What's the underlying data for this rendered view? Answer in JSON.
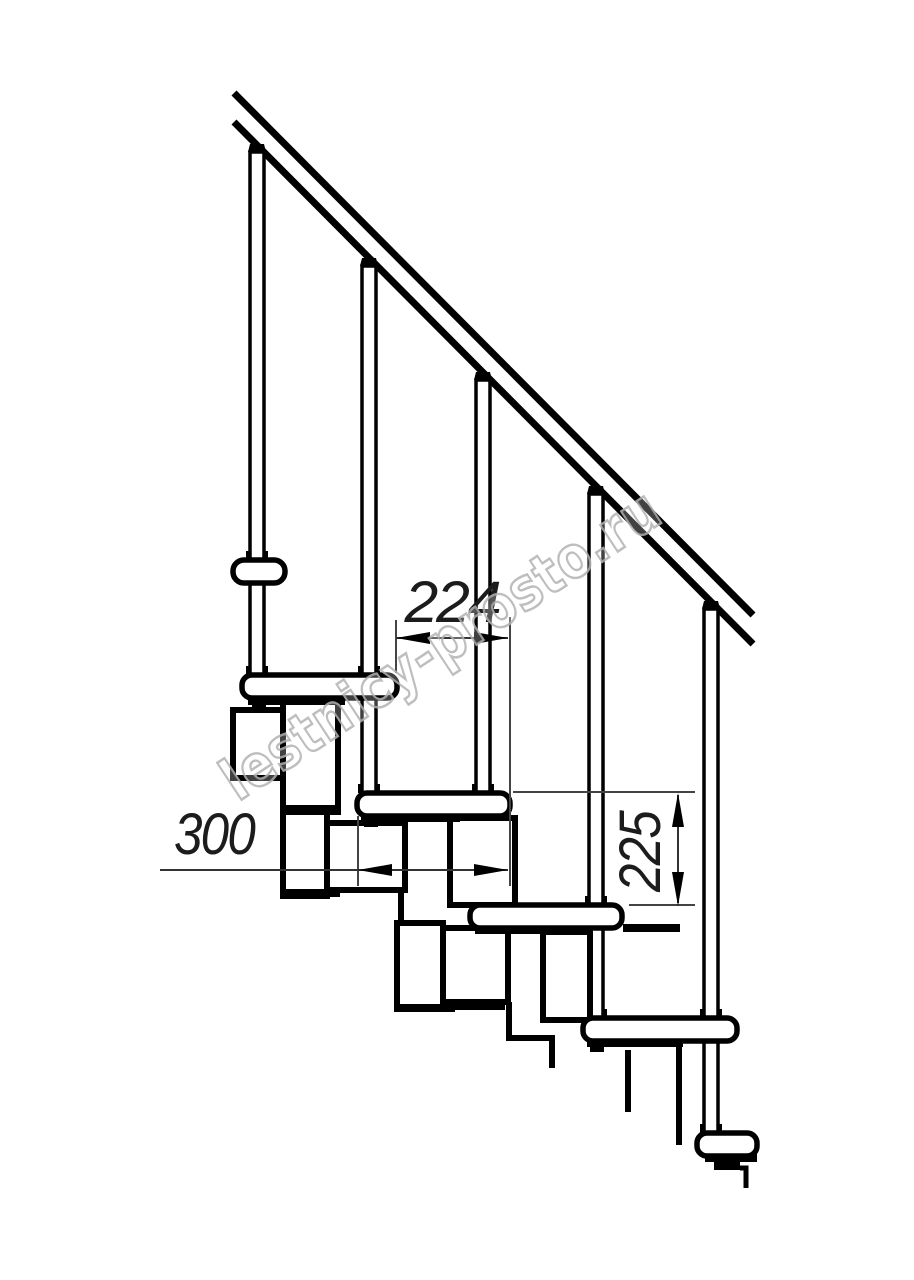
{
  "drawing": {
    "type": "technical-line-drawing",
    "subject": "modular staircase side elevation with railing",
    "watermark": "lestnicy-prosto.ru",
    "dimensions": {
      "going_mm": "224",
      "tread_depth_mm": "300",
      "rise_mm": "225"
    },
    "parts": {
      "handrail": "handrail",
      "balusters": [
        "baluster-1",
        "baluster-2",
        "baluster-3",
        "baluster-4",
        "baluster-5"
      ],
      "treads": [
        "tread-end-upper",
        "tread-1",
        "tread-2",
        "tread-3",
        "tread-4",
        "tread-5"
      ],
      "modules": "support-module-chain"
    },
    "colors": {
      "line": "#000000",
      "dimension_line": "#3c3c3c",
      "dimension_text": "#1c1c1c",
      "watermark_stroke": "#b3b3b3",
      "background": "#ffffff"
    }
  }
}
